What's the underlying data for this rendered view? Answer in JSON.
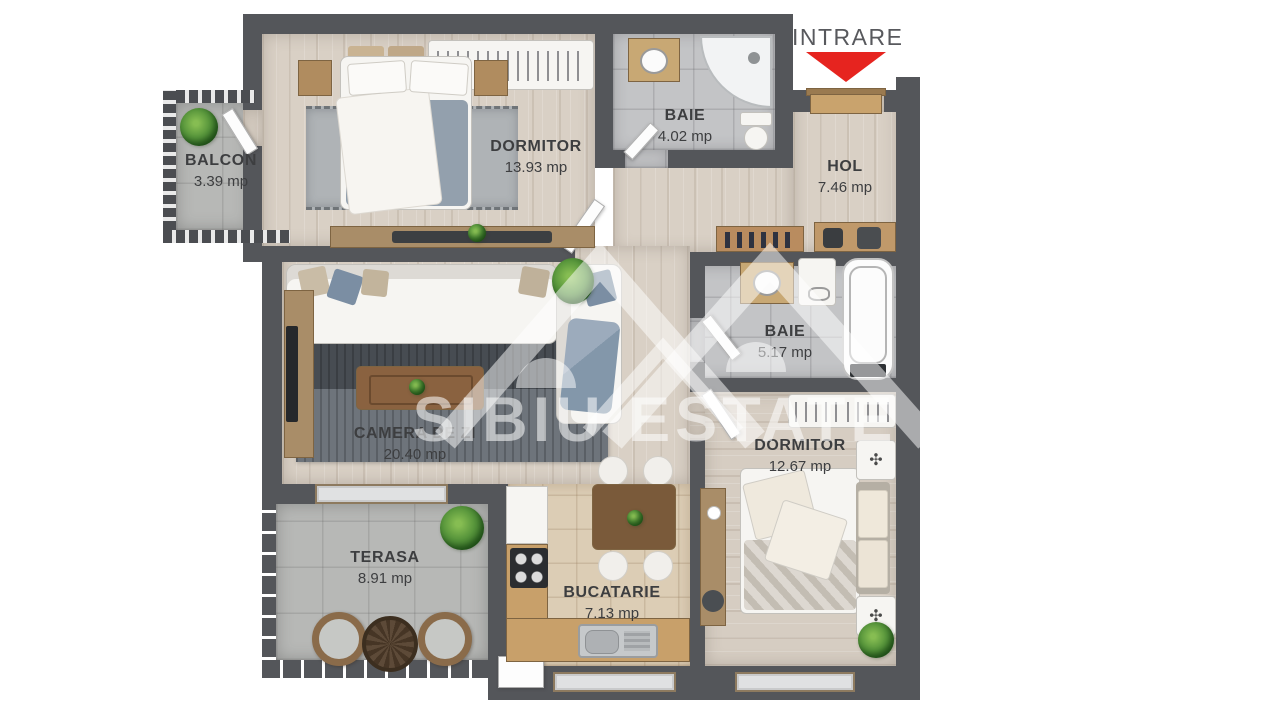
{
  "entrance": {
    "label": "INTRARE",
    "arrow_color": "#e6241f"
  },
  "watermark": {
    "text": "SIBIU ESTATE"
  },
  "rooms": [
    {
      "key": "balcon",
      "name": "BALCON",
      "area": "3.39 mp"
    },
    {
      "key": "dormitor1",
      "name": "DORMITOR",
      "area": "13.93 mp"
    },
    {
      "key": "baie1",
      "name": "BAIE",
      "area": "4.02 mp"
    },
    {
      "key": "hol",
      "name": "HOL",
      "area": "7.46 mp"
    },
    {
      "key": "baie2",
      "name": "BAIE",
      "area": "5.17 mp"
    },
    {
      "key": "camera",
      "name": "CAMERA DE ZI",
      "area": "20.40 mp"
    },
    {
      "key": "dormitor2",
      "name": "DORMITOR",
      "area": "12.67 mp"
    },
    {
      "key": "terasa",
      "name": "TERASA",
      "area": "8.91 mp"
    },
    {
      "key": "bucatarie",
      "name": "BUCATARIE",
      "area": "7.13 mp"
    }
  ],
  "colors": {
    "walls": "#54565a",
    "entrance_arrow": "#e6241f",
    "watermark": "#ffffff"
  }
}
